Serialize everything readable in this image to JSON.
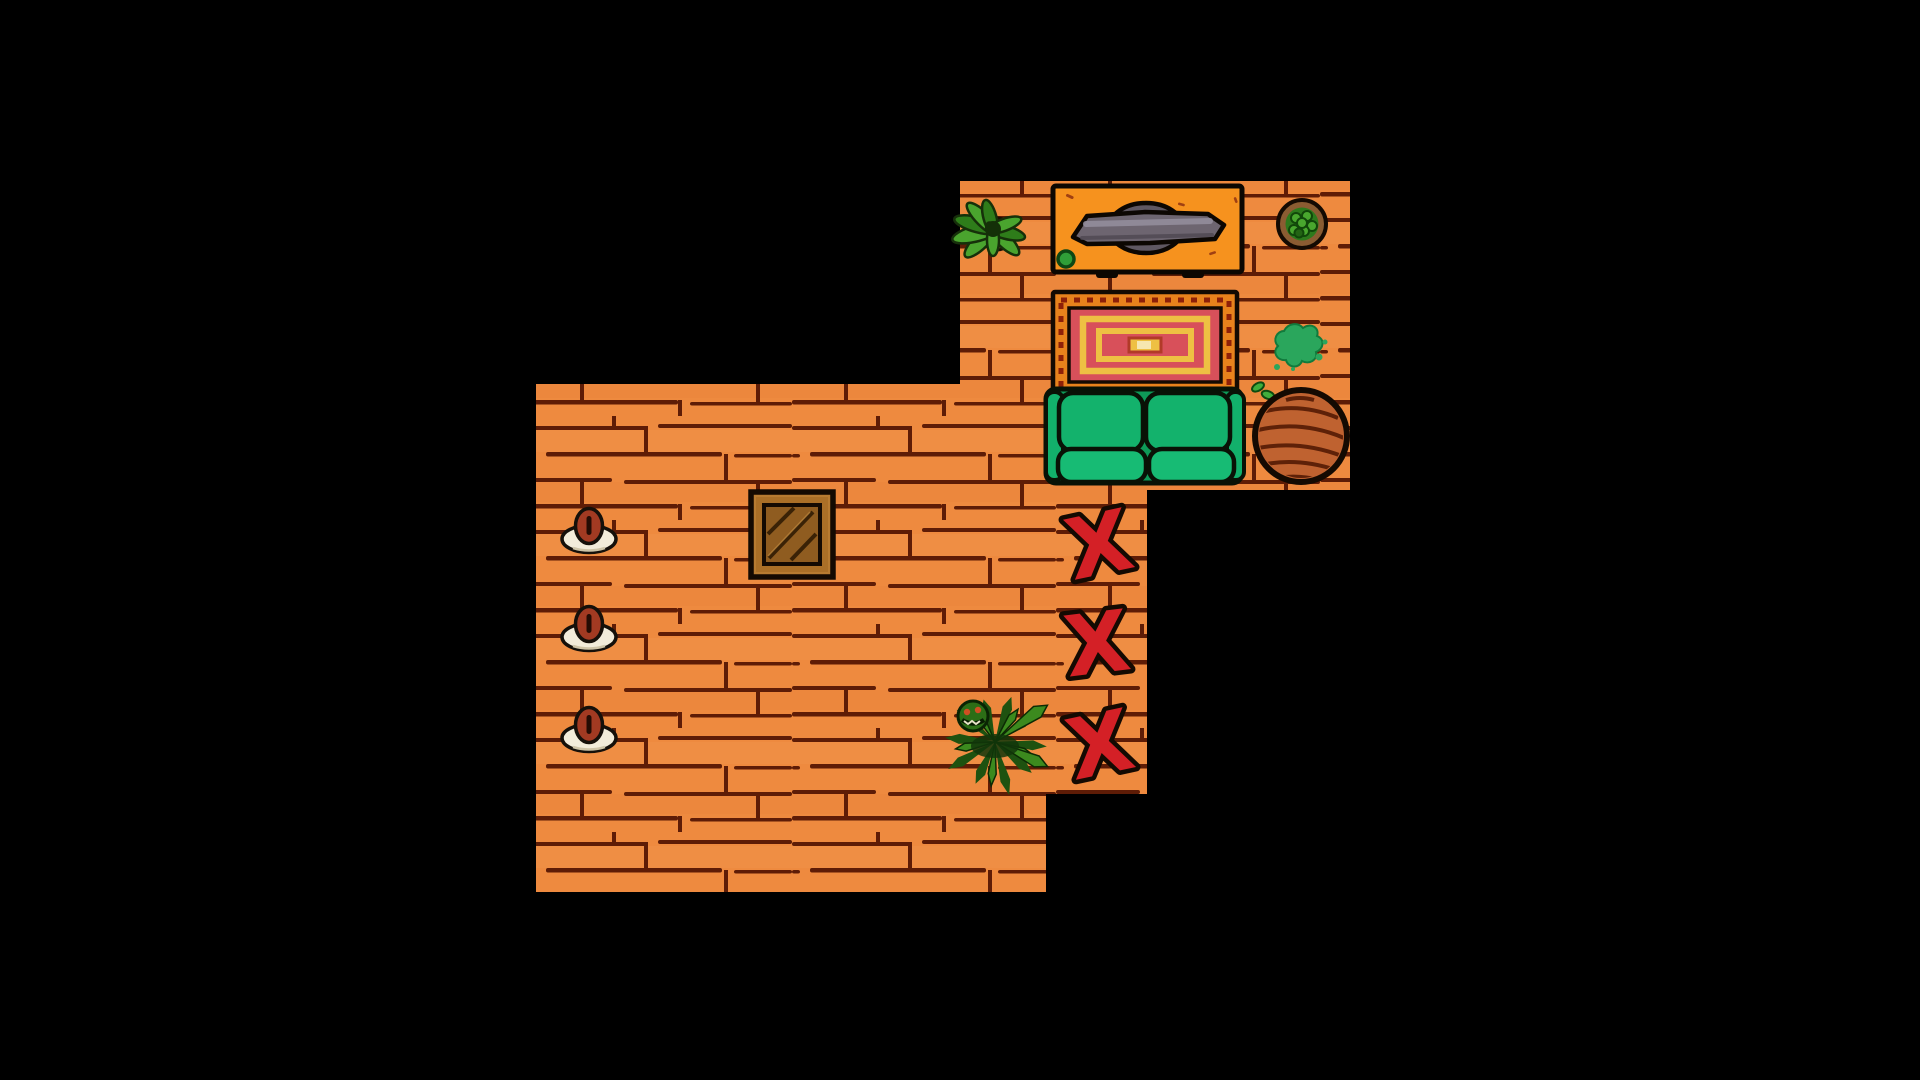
{
  "app": {
    "kind": "top-down 2D game scene (hand-drawn cartoon interior)",
    "background_color": "#000000"
  },
  "scene": {
    "x_mark": {
      "glyph": "X",
      "count": 3,
      "color": "#d42026"
    },
    "rooms": [
      {
        "id": "living-room",
        "position": "upper right",
        "floor_color": "#ee8a3f",
        "plank_line_color": "#5e1c06",
        "contents": "houseplant, TV on orange stand, round potted plant, spiral rug, green couch, slime splat, scraps, round wooden table"
      },
      {
        "id": "big-room",
        "position": "lower left",
        "floor_color": "#ee8a3f",
        "plank_line_color": "#5e1c06",
        "contents": "three bean plates along left wall, wooden crate, spiky snap-plant"
      },
      {
        "id": "side-strip",
        "position": "right edge of big room",
        "floor_color": "#ee8a3f",
        "plank_line_color": "#5e1c06",
        "contents": "three red X floor markers in a vertical row"
      }
    ],
    "entities": [
      {
        "name": "houseplant",
        "room": "living-room",
        "description": "leafy green plant in top-left corner",
        "leaf_color": "#4aa42e"
      },
      {
        "name": "tv-stand",
        "room": "living-room",
        "description": "bright orange media stand with green knob and two feet",
        "color": "#f6921e"
      },
      {
        "name": "tv",
        "room": "living-room",
        "description": "flat gray saucer-shaped TV lying on the stand",
        "color": "#6d6570"
      },
      {
        "name": "potted-plant",
        "room": "living-room",
        "description": "round brown pot with green shrub, top-right",
        "pot_color": "#8a5c32"
      },
      {
        "name": "rug",
        "room": "living-room",
        "description": "square spiral rug, orange stitched border, red field, yellow spiral",
        "colors": [
          "#e8821c",
          "#d8505a",
          "#eec043"
        ]
      },
      {
        "name": "couch",
        "room": "living-room",
        "description": "green two-seat couch over bottom of rug",
        "color": "#13b26c"
      },
      {
        "name": "slime-splat",
        "room": "living-room",
        "description": "green goo splat with droplets",
        "color": "#2aa65c"
      },
      {
        "name": "scraps",
        "room": "living-room",
        "description": "two small green pods left of round table",
        "color": "#3fae3c"
      },
      {
        "name": "round-table",
        "room": "living-room",
        "description": "round wooden table with grain streaks",
        "color": "#bf6230"
      },
      {
        "name": "bean-plate",
        "room": "big-room",
        "count": 3,
        "description": "cream saucer holding one reddish-brown bean; three in a vertical row on left wall",
        "saucer_color": "#f2ecda",
        "bean_color": "#a23a22"
      },
      {
        "name": "crate",
        "room": "big-room",
        "description": "square wooden crate with diagonal planks",
        "color": "#aa6f27"
      },
      {
        "name": "snap-plant",
        "room": "big-room",
        "description": "spiky green monster plant with small orange eyes",
        "color": "#3c8a1e"
      },
      {
        "name": "x-mark",
        "room": "side-strip",
        "count": 3,
        "description": "bold red X markers with black outline",
        "color": "#d42026"
      }
    ]
  }
}
